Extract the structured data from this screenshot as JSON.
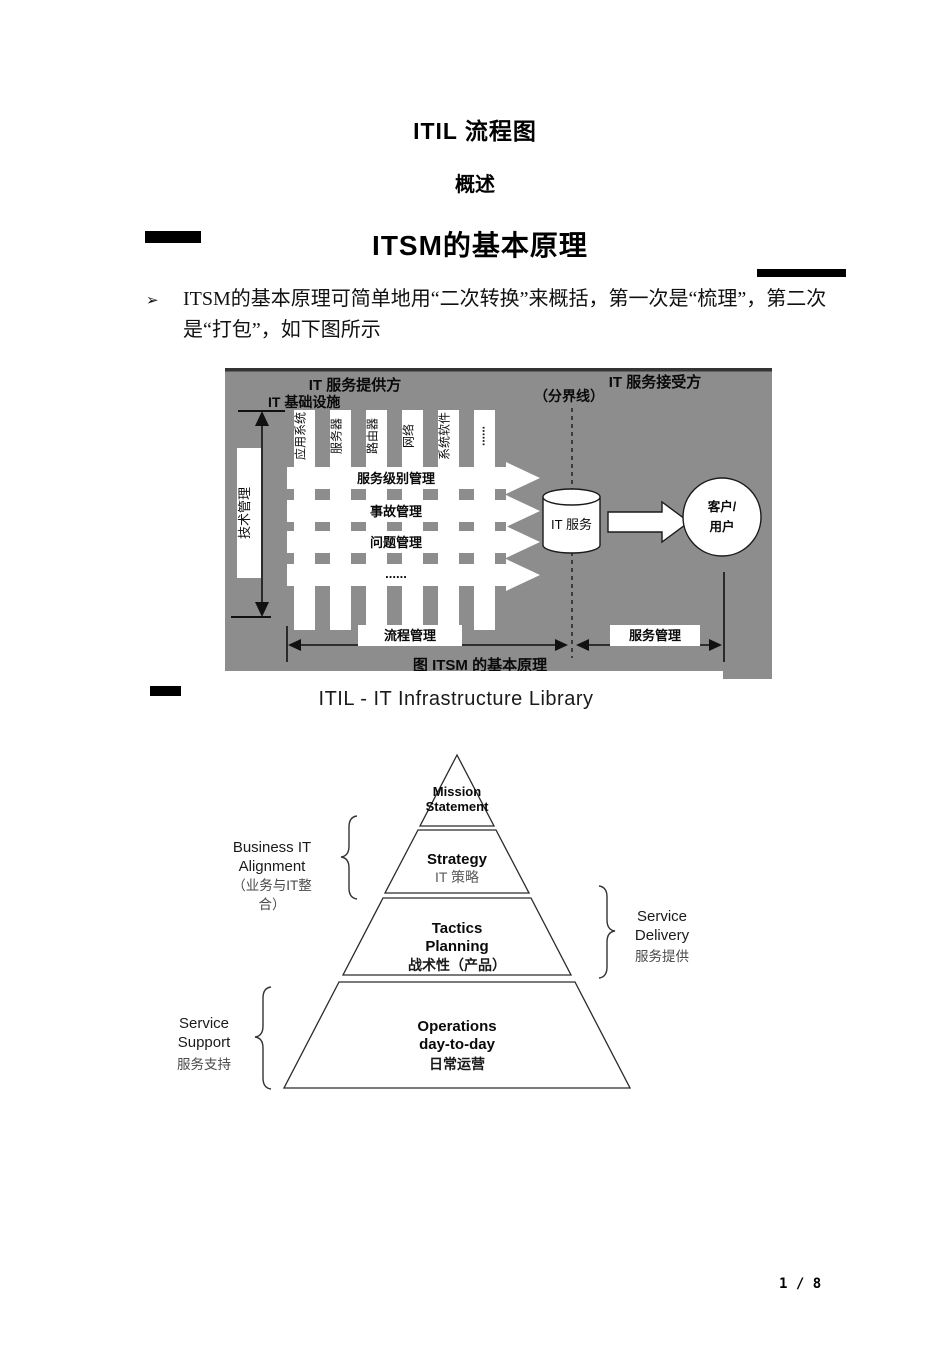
{
  "page": {
    "title": "ITIL 流程图",
    "subtitle": "概述",
    "page_number": "1 / 8"
  },
  "section": {
    "heading": "ITSM的基本原理",
    "bullet_glyph": "➢",
    "bullet_text": "ITSM的基本原理可简单地用“二次转换”来概括，第一次是“梳理”，第二次是“打包”，如下图所示"
  },
  "itsm_figure": {
    "provider_label": "IT 服务提供方",
    "receiver_label": "IT 服务接受方",
    "infrastructure_label": "IT 基础设施",
    "boundary_label": "（分界线）",
    "tech_mgmt_label": "技术管理",
    "columns": [
      "应用系统",
      "服务器",
      "路由器",
      "网络",
      "系统软件",
      "......"
    ],
    "process_arrows": [
      "服务级别管理",
      "事故管理",
      "问题管理",
      "......"
    ],
    "it_service_label": "IT 服务",
    "customer_line1": "客户/",
    "customer_line2": "用户",
    "process_mgmt_label": "流程管理",
    "service_mgmt_label": "服务管理",
    "caption": "图  ITSM 的基本原理",
    "colors": {
      "figure_bg": "#8d8d8d",
      "top_border": "#343434",
      "shape_fill": "#ffffff",
      "outline": "#1a1a1a"
    }
  },
  "itil_section": {
    "heading": "ITIL - IT Infrastructure Library",
    "pyramid": {
      "tier1": {
        "line1": "Mission",
        "line2": "Statement"
      },
      "tier2": {
        "line1": "Strategy",
        "line2": "IT 策略"
      },
      "tier3": {
        "line1": "Tactics",
        "line2": "Planning",
        "line3": "战术性（产品）"
      },
      "tier4": {
        "line1": "Operations",
        "line2": "day-to-day",
        "line3": "日常运营"
      }
    },
    "side_labels": {
      "business_it_1": "Business IT",
      "business_it_2": "Alignment",
      "business_it_3": "（业务与IT整",
      "business_it_4": "合）",
      "service_delivery_1": "Service",
      "service_delivery_2": "Delivery",
      "service_delivery_3": "服务提供",
      "service_support_1": "Service",
      "service_support_2": "Support",
      "service_support_3": "服务支持"
    }
  }
}
